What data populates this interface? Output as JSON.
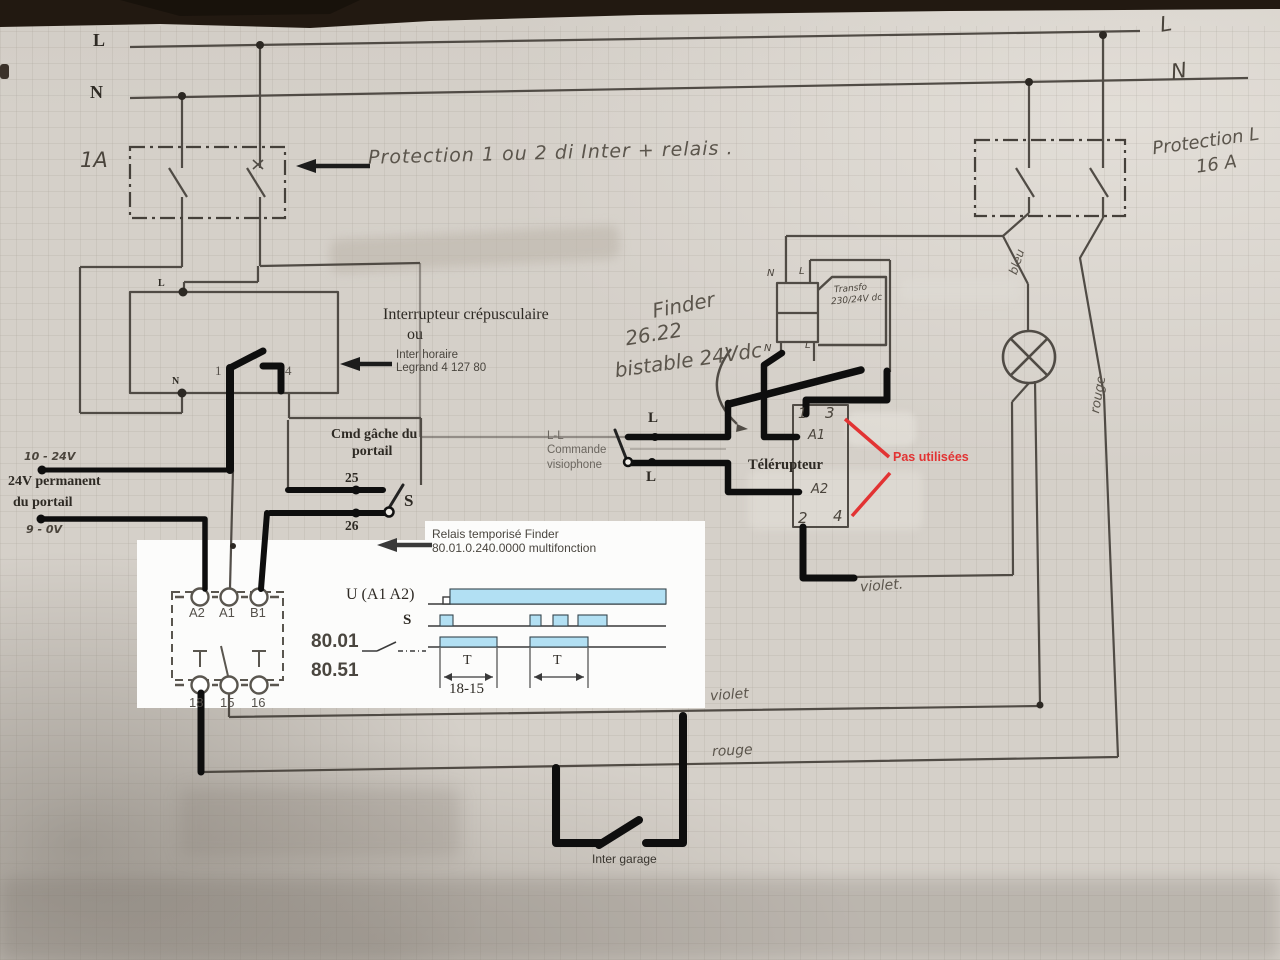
{
  "colors": {
    "paper": "#d5d0c9",
    "pencil": "#45403a",
    "marker": "#0e0e0e",
    "red_annotation": "#e23333",
    "wave_fill": "#b2e0f3",
    "table_edge": "#221911"
  },
  "rails": {
    "l_left": "L",
    "n_left": "N",
    "l_right": "L",
    "n_right": "N"
  },
  "protection_left": {
    "rating": "1A",
    "note": "Protection 1 ou 2 di   Inter + relais ."
  },
  "protection_right": {
    "line1": "Protection L",
    "line2": "16 A"
  },
  "crepusculaire": {
    "title1": "Interrupteur crépusculaire",
    "title2": "ou",
    "alt1": "Inter horaire",
    "alt2": "Legrand 4 127 80",
    "pin_l": "L",
    "pin_n": "N",
    "pin_1": "1",
    "pin_4": "4"
  },
  "cmd_gache": {
    "line1": "Cmd  gâche du",
    "line2": "portail",
    "t25": "25",
    "t26": "26",
    "s": "S"
  },
  "supply": {
    "hw_plus": "10 - 24V",
    "line1": "24V permanent",
    "line2": "du portail",
    "hw_minus": "9 - 0V"
  },
  "timer_relay": {
    "note1": "Relais temporisé Finder",
    "note2": "80.01.0.240.0000 multifonction",
    "pins_top": [
      "A2",
      "A1",
      "B1"
    ],
    "pins_bottom": [
      "18",
      "15",
      "16"
    ],
    "model1": "80.01",
    "model2": "80.51"
  },
  "timing": {
    "u_label": "U (A1 A2)",
    "s_label": "S",
    "t_label": "T",
    "interval_label": "18-15"
  },
  "chart_data": {
    "type": "area",
    "title": "Diagramme de fonctionnement relais 80.01 / 80.51",
    "x_unit": "temps (relatif 0-1)",
    "rows": [
      {
        "name": "U (A1 A2)",
        "intervals_on": [
          [
            0.09,
            1.0
          ]
        ]
      },
      {
        "name": "S",
        "intervals_on": [
          [
            0.05,
            0.105
          ],
          [
            0.43,
            0.475
          ],
          [
            0.525,
            0.59
          ],
          [
            0.63,
            0.75
          ]
        ]
      },
      {
        "name": "18-15",
        "intervals_on": [
          [
            0.05,
            0.29
          ],
          [
            0.43,
            0.67
          ]
        ]
      }
    ],
    "annotations": [
      "T",
      "T",
      "18-15"
    ]
  },
  "finder_bistable": {
    "line1": "Finder",
    "line2": "26.22",
    "line3": "bistable 24Vdc"
  },
  "transformer": {
    "label1": "Transfo",
    "label2": "230/24V dc",
    "top_n": "N",
    "top_l": "L",
    "bot_n": "N",
    "bot_l": "L"
  },
  "visiophone": {
    "line1": "L-L",
    "line2": "Commande",
    "line3": "visiophone",
    "l_top": "L",
    "l_bottom": "L"
  },
  "telerupteur": {
    "name": "Télérupteur",
    "unused": "Pas utilisées",
    "pins": {
      "p1": "1",
      "p3": "3",
      "a1": "A1",
      "a2": "A2",
      "p2": "2",
      "p4": "4"
    }
  },
  "wire_colors": {
    "bleu": "bleu",
    "rouge_vertical": "rouge",
    "violet_mid": "violet.",
    "violet": "violet",
    "rouge": "rouge"
  },
  "inter_garage": {
    "label": "Inter garage"
  }
}
